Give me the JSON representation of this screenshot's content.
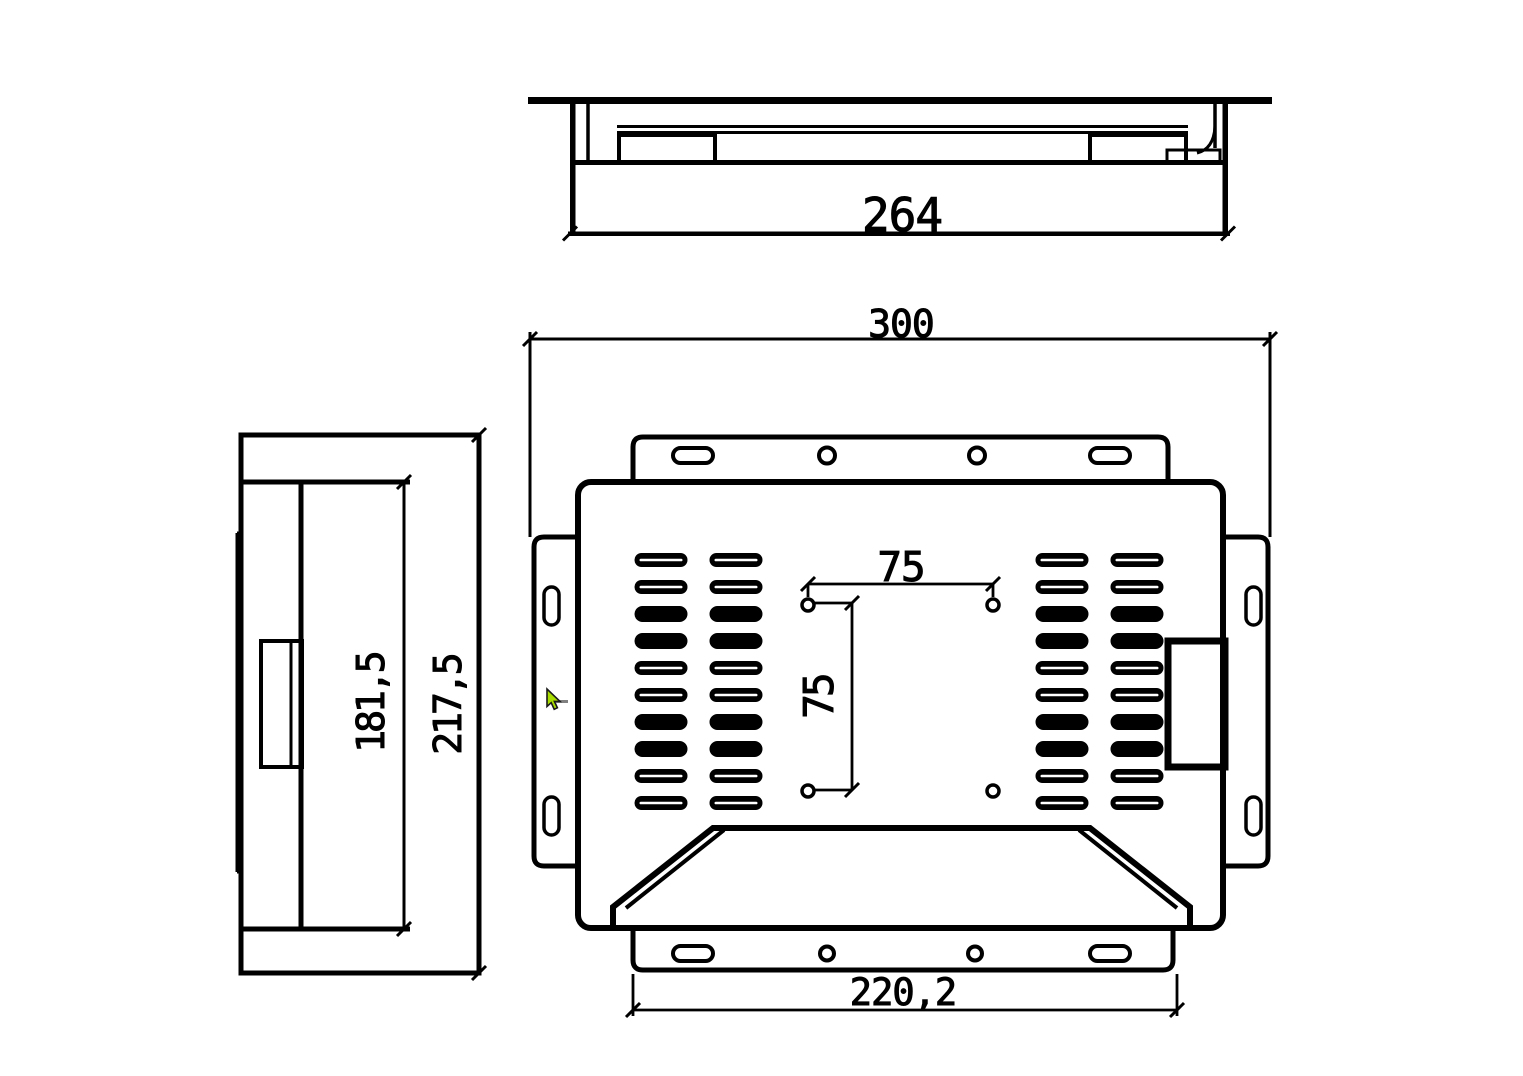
{
  "drawing": {
    "dimensions": {
      "top_view_width": "264",
      "overall_width": "300",
      "vesa_horizontal": "75",
      "vesa_vertical": "75",
      "bottom_mount_width": "220,2",
      "chassis_height": "181,5",
      "overall_height": "217,5"
    },
    "colors": {
      "line": "#000000",
      "background": "#ffffff",
      "cursor_fill": "#a8dc00",
      "cursor_outline": "#1a1a1a",
      "cursor_shadow": "#808080"
    }
  }
}
